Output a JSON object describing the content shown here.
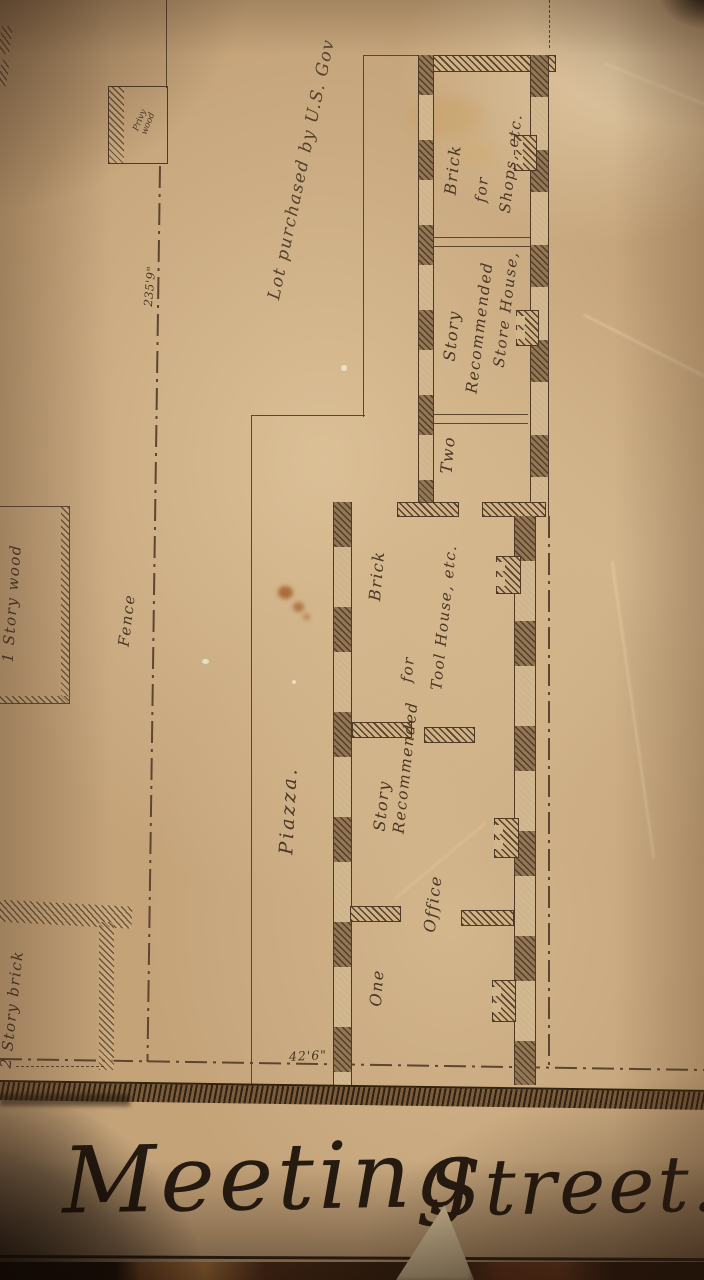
{
  "document": {
    "kind": "historic site plan photograph",
    "street": {
      "word1": "Meeting",
      "word2": "Street."
    },
    "labels": {
      "lot_note": "Lot purchased by U.S. Gov",
      "fence": "Fence",
      "dim_fence": "235'9\"",
      "dim_front": "42'6\"",
      "privy": {
        "line1": "Privy",
        "line2": "wood"
      },
      "wood_building": "1 Story wood",
      "brick_building": "2 Story brick",
      "piazza": "Piazza."
    },
    "one_story_building": {
      "one": "One",
      "story": "Story",
      "brick": "Brick",
      "recommended": "Recommended",
      "for": "for",
      "office": "Office",
      "tool_house": "Tool House, etc."
    },
    "two_story_building": {
      "two": "Two",
      "story": "Story",
      "brick": "Brick",
      "recommended": "Recommended",
      "for": "for",
      "store_house": "Store House,",
      "shops": "Shops, etc."
    },
    "colors": {
      "paper": "#c4a379",
      "ink": "#5d4530",
      "text_ink": "#4a3526",
      "street_script_ink": "#261b11",
      "street_band": "#3a2a18"
    }
  }
}
